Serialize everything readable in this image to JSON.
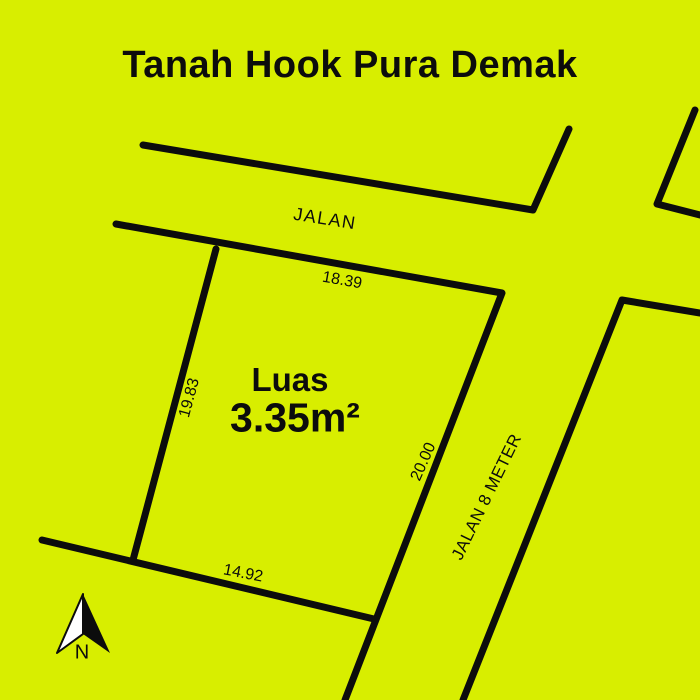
{
  "title": "Tanah Hook Pura Demak",
  "colors": {
    "background": "#d8ee00",
    "line": "#0c0c0c",
    "arrow_fill": "#ffffff"
  },
  "roads": {
    "main_label": "JALAN",
    "side_label": "JALAN 8 METER"
  },
  "plot": {
    "area_label": "Luas",
    "area_value": "3.35m²",
    "dim_top": "18.39",
    "dim_left": "19.83",
    "dim_right": "20.00",
    "dim_bottom": "14.92"
  },
  "compass": {
    "label": "N"
  }
}
